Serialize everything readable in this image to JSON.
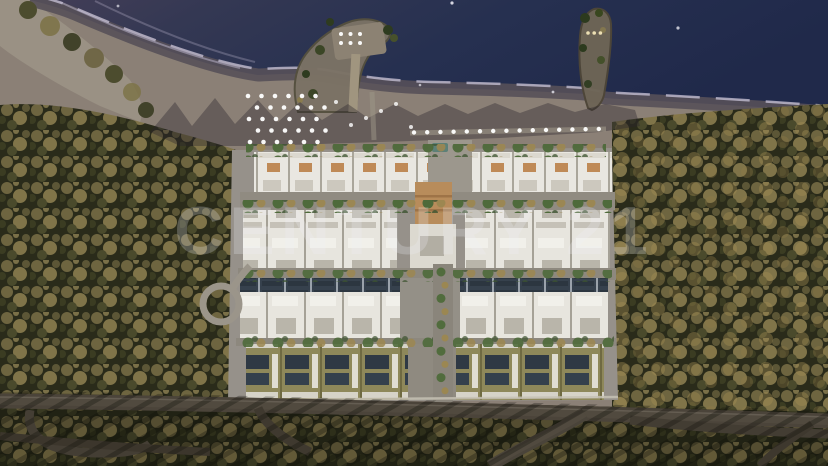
{
  "watermark": {
    "text": "CENTURY 21"
  },
  "palette": {
    "sea_deep": "#20294a",
    "sea_shallow": "#453e57",
    "foam": "#c9c4d8",
    "beach_sand": "#8b8076",
    "wet_sand": "#575059",
    "dry_sand_corner": "#9a9184",
    "forest_base": "#2a2b1a",
    "tree_gold": "#8a7c4e",
    "tree_olive": "#6e6540",
    "platform_concrete": "#96918a",
    "building_white": "#e9e7e1",
    "roof_terracotta": "#bf8a57",
    "clubhouse_roof": "#b88c5b",
    "solar_panel": "#36414d",
    "roof_olive": "#8e885a",
    "asphalt_road": "#4b443a",
    "complex_tree_green": "#4e6a3a",
    "complex_tree_gold": "#9c8750",
    "umbrella_white": "#ffffff",
    "pier_sand": "#7b7265",
    "jetty_rock": "#6e6556",
    "pier_light": "#f3e6b8",
    "pool_teal": "#5d8077"
  },
  "features": {
    "beach_umbrella_grid": {
      "rows": 5,
      "cols": 6
    },
    "scattered_umbrellas": 6,
    "promenade_lights": 15,
    "avenue_trees": 10,
    "left_pier_umbrellas": {
      "rows": 2,
      "cols": 3
    },
    "right_pier_lights": 3
  }
}
